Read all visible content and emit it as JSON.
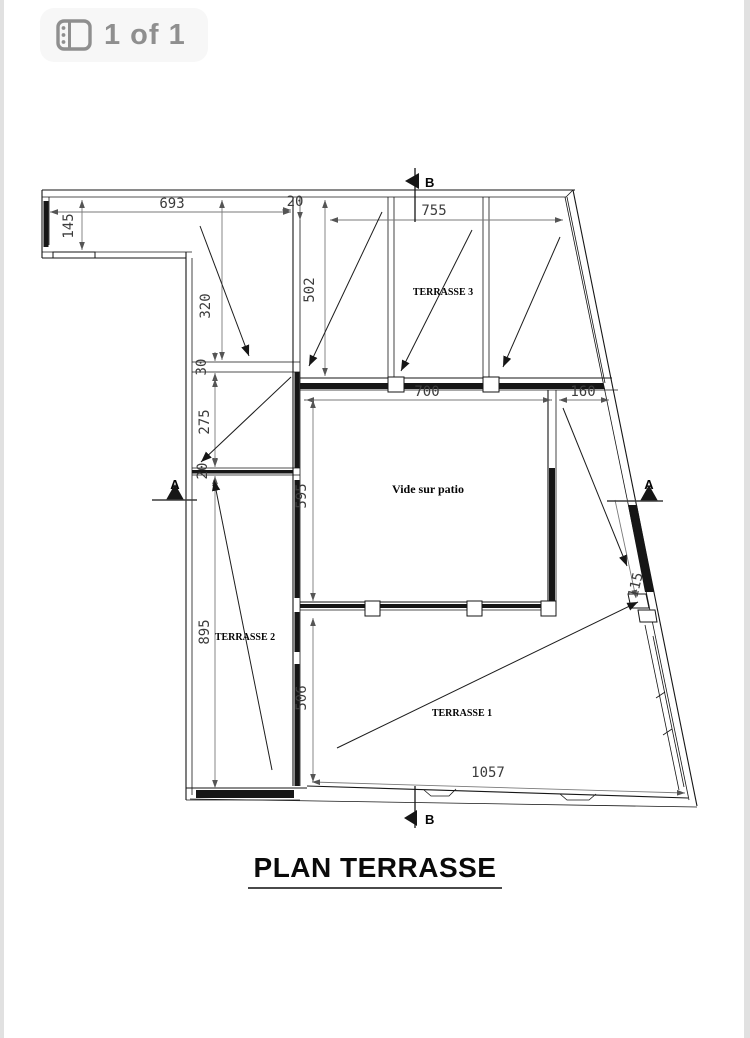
{
  "viewer": {
    "page_indicator": "1 of 1"
  },
  "colors": {
    "badge_text": "#8f8f8f",
    "badge_background": "#f7f7f7",
    "drawing_line": "#161616",
    "dimension_line": "#7a7a7a",
    "dimension_text": "#3c3c3c"
  },
  "plan": {
    "title": "PLAN TERRASSE",
    "labels": {
      "terrasse1": "TERRASSE 1",
      "terrasse2": "TERRASSE 2",
      "terrasse3": "TERRASSE 3",
      "patio": "Vide sur patio"
    },
    "sections": {
      "a": "A",
      "b": "B"
    },
    "dims": {
      "d693": "693",
      "d145": "145",
      "d20_top": "20",
      "d320": "320",
      "d30": "30",
      "d275": "275",
      "d20_left": "20",
      "d895": "895",
      "d502": "502",
      "d755": "755",
      "d700": "700",
      "d160": "160",
      "d595": "595",
      "d506": "506",
      "d1057": "1057",
      "d115": "115"
    }
  }
}
